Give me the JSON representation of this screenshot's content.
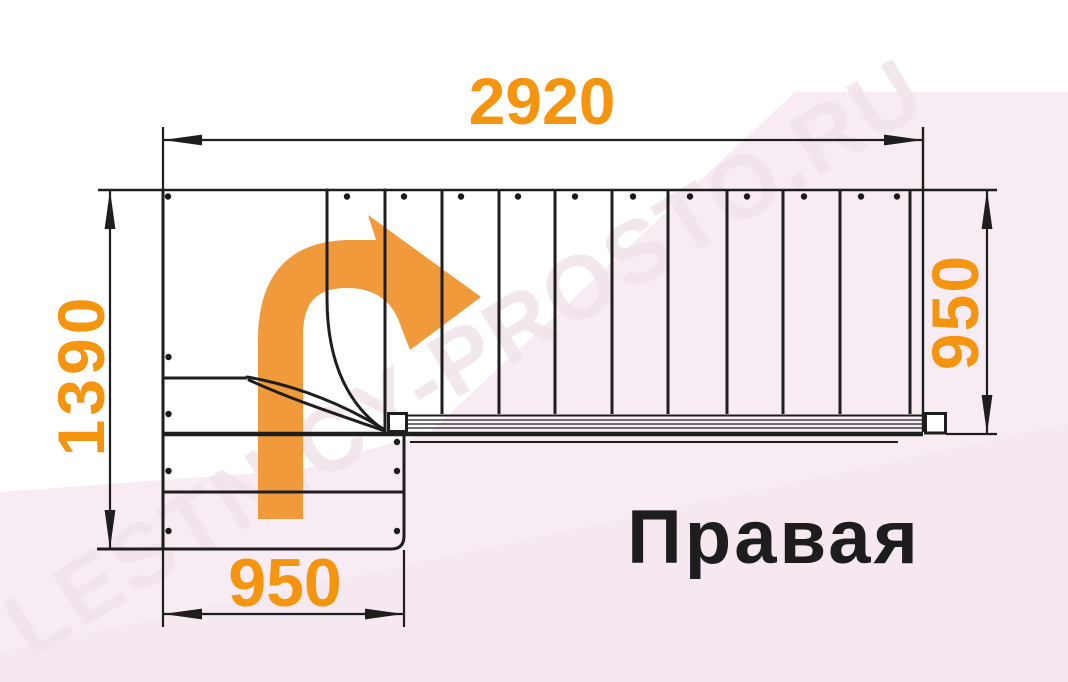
{
  "diagram": {
    "kind": "stair-plan-top-view",
    "direction_label": "Правая"
  },
  "dimensions": {
    "top_length": "2920",
    "left_depth": "1390",
    "right_width": "950",
    "bottom_width": "950"
  },
  "watermark": {
    "text": "LESTNICY-PROSTO.RU"
  },
  "icons": {
    "walk_direction_arrow": "curved-right-arrow"
  },
  "colors": {
    "dimension_text": "#F4940F",
    "arrow_orange": "#F09A3C",
    "line_black": "#1E1E1E",
    "background_pink": "#F7ECF3",
    "label_black": "#1D1D1D"
  }
}
